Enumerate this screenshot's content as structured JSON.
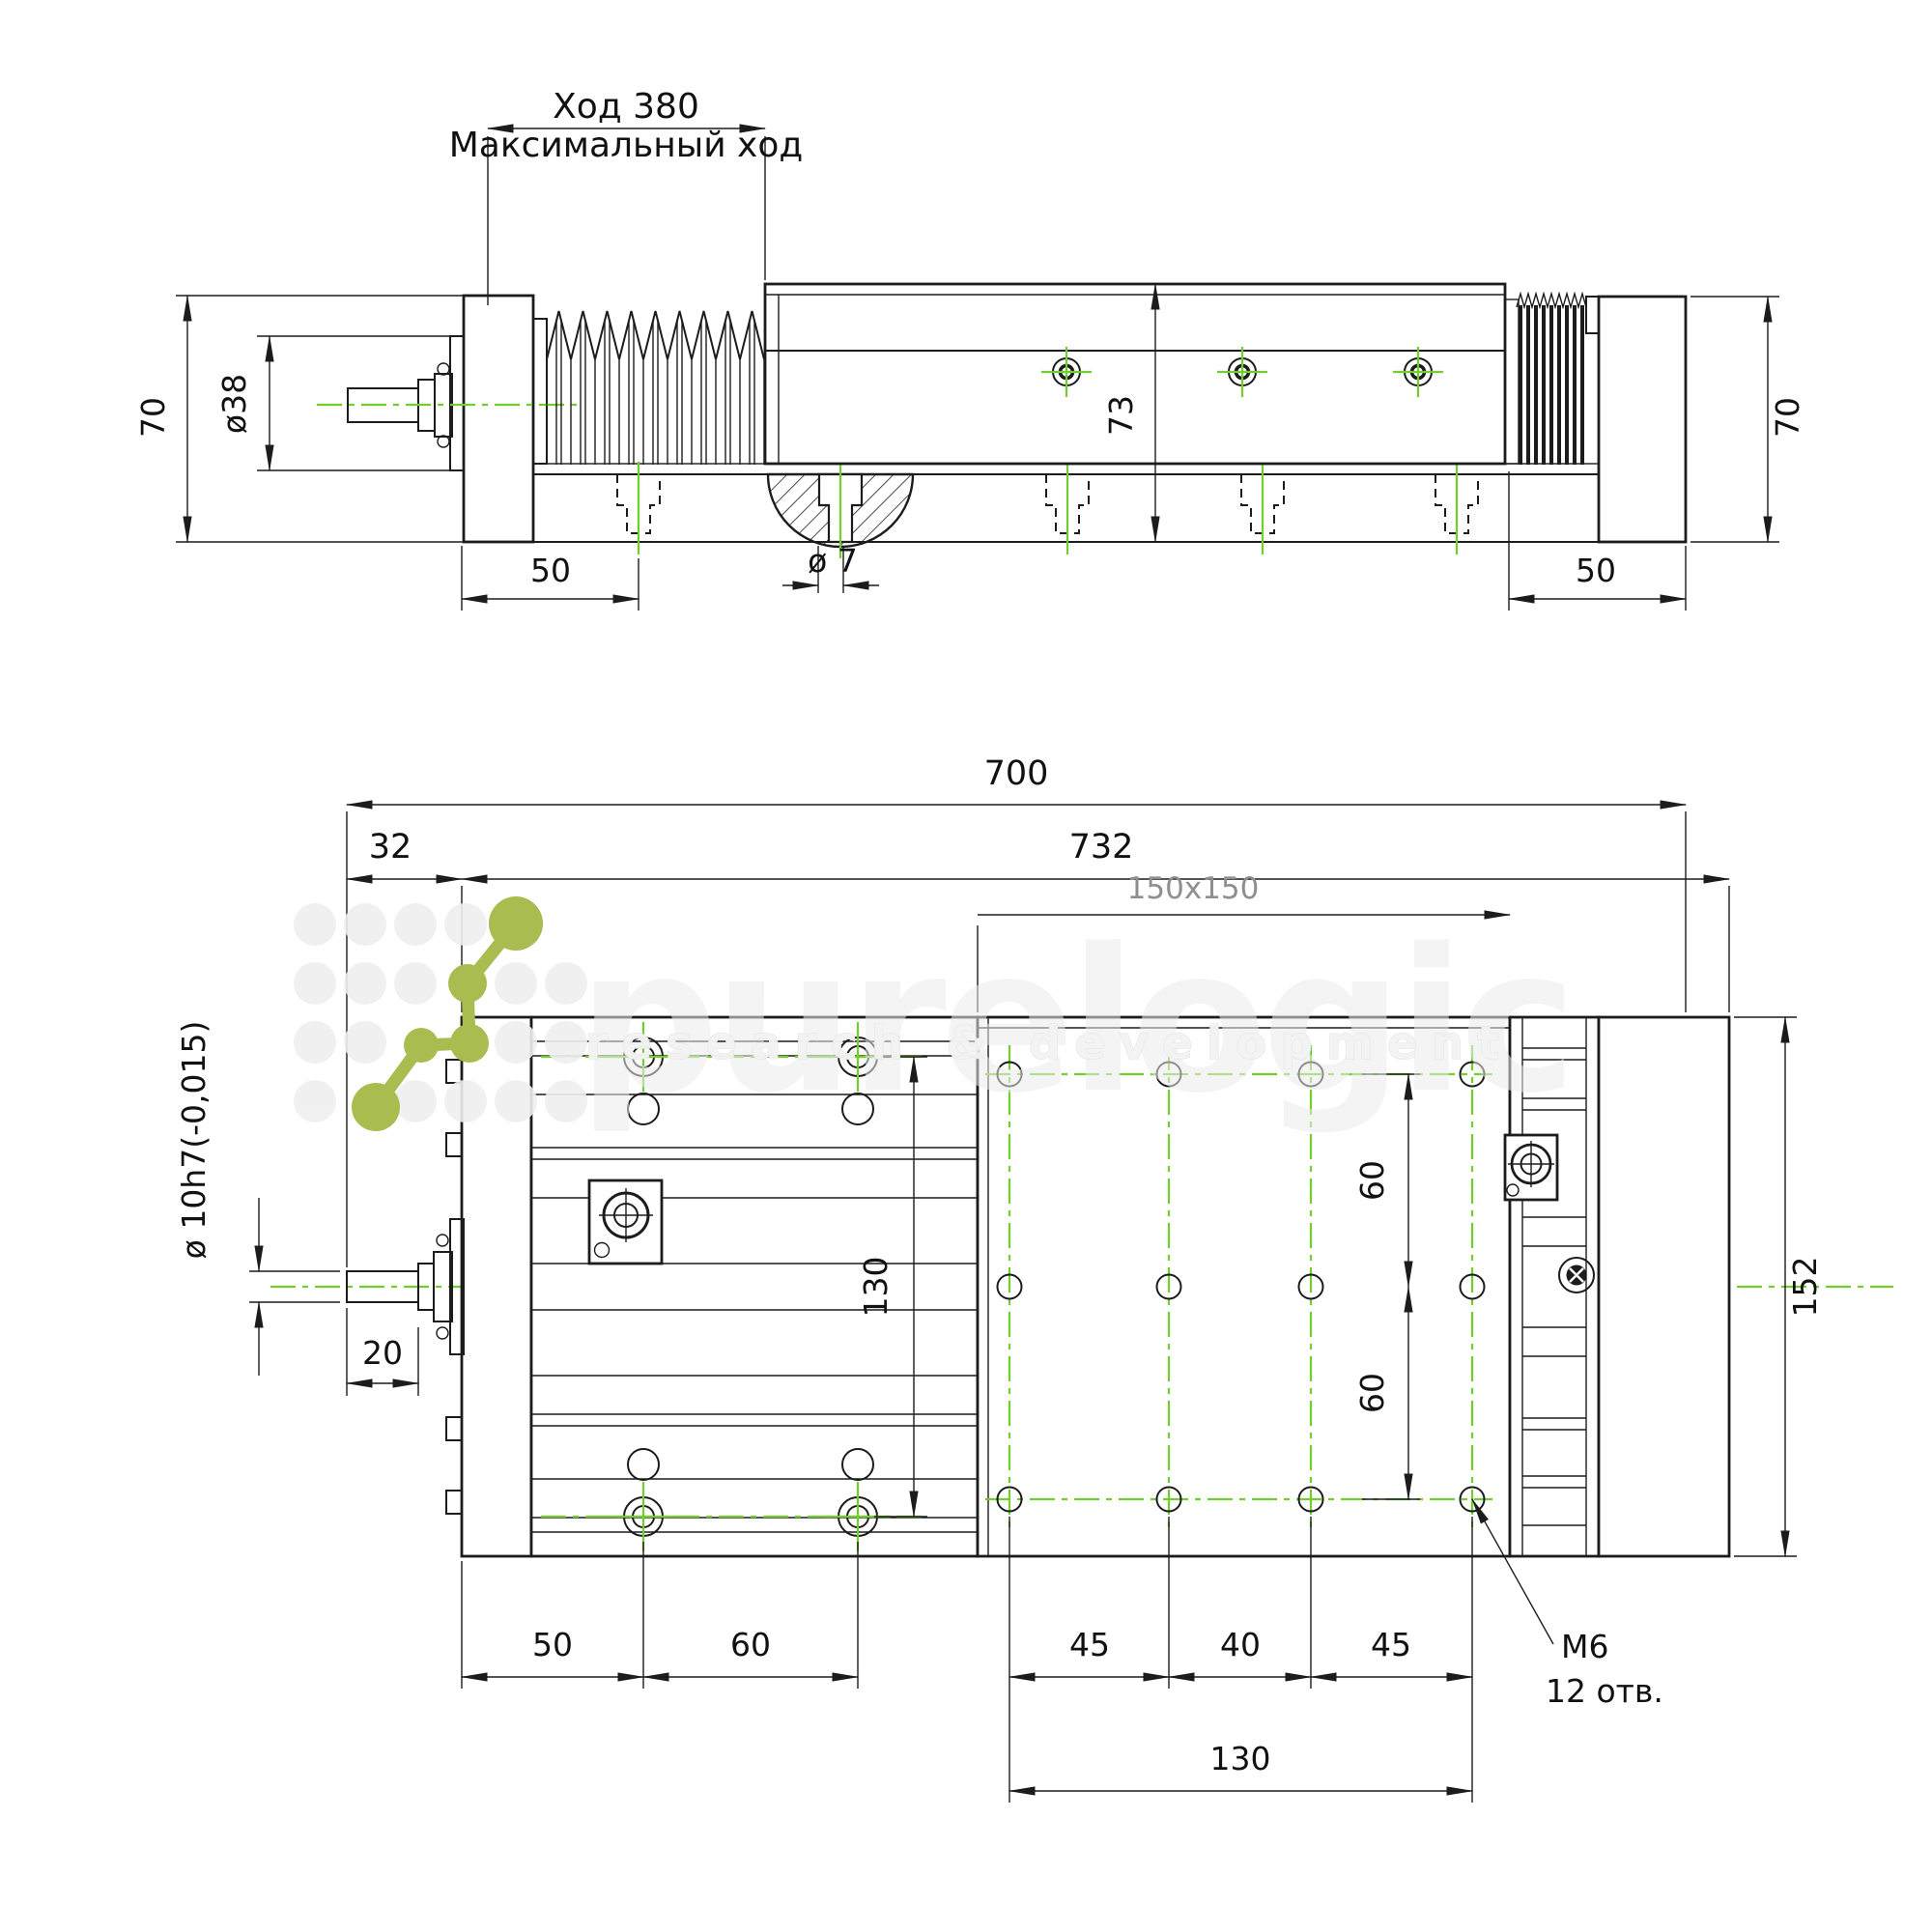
{
  "page": {
    "background": "#ffffff"
  },
  "colors": {
    "line": "#1c1c1c",
    "centerline_green": "#72ce2c",
    "logo_olive": "#a9bc50",
    "watermark_gray": "#ececec",
    "dim_text": "#111111",
    "table_label_gray": "#8f8f8f"
  },
  "top_view": {
    "stroke_label": "Ход 380",
    "stroke_note": "Максимальный ход",
    "height_left": "70",
    "shaft_diameter": "ø38",
    "base_offset_left": "50",
    "hole_diameter": "ø 7",
    "profile_height": "73",
    "base_offset_right": "50",
    "height_right": "70"
  },
  "bottom_view": {
    "total_length": "700",
    "shaft_offset": "32",
    "extended_length": "732",
    "table_size": "150x150",
    "motor_shaft_diameter": "ø 10h7(-0,015)",
    "shaft_length": "20",
    "body_hole_spacing": "130",
    "table_row_spacing_top": "60",
    "table_row_spacing_bottom": "60",
    "table_height": "152",
    "base_offset": "50",
    "base_hole_spacing": "60",
    "table_col_spacing_a": "45",
    "table_col_spacing_b": "40",
    "table_col_spacing_c": "45",
    "table_col_span": "130",
    "thread_label": "M6",
    "holes_note": "12 отв."
  },
  "watermark": {
    "brand": "purelogic",
    "tagline": "research & development"
  }
}
